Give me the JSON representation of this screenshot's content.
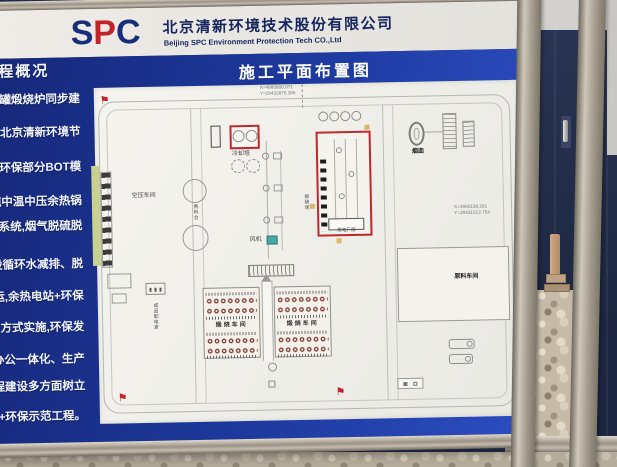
{
  "sign": {
    "header": {
      "logo": {
        "s": "S",
        "p": "P",
        "c": "C"
      },
      "company_cn": "北京清新环境技术股份有限公司",
      "company_en": "Beijing SPC Environment Protection Tech CO.,Ltd"
    },
    "sidebar": {
      "heading": "程概况",
      "lines": [
        "64罐煅烧炉同步建",
        "由北京清新环境节",
        "C+环保部分BOT模",
        "吨中温中压余热锅",
        "保系统,烟气脱硫脱",
        "步建设循环水减排、脱",
        "投运,余热电站+环保",
        "设的方式实施,环保发",
        "生产办公一体化、生产",
        "程、工程建设多方面树立",
        "电+环保示范工程。"
      ]
    },
    "plan": {
      "title": "施工平面布置图",
      "coords_top": {
        "x": "X=4980800.971",
        "y": "Y=29432875.366"
      },
      "coords_right": {
        "x": "X=4980138.291",
        "y": "Y=29431012.754"
      },
      "labels": {
        "cooling_tower": "冷却塔",
        "clinker_silo": "熟料仓",
        "left_workshop": "空压车间",
        "desulfurizer": "脱硫塔",
        "fan": "风机",
        "power_plant": "发电厂房",
        "chimney": "烟囱",
        "raw_material": "原料车间",
        "kiln_left": "煅烧车间",
        "kiln_right": "煅烧车间",
        "distribution_room": "成品配电室"
      }
    }
  },
  "colors": {
    "panel_blue": "#1e3a9f",
    "logo_navy": "#172f7b",
    "logo_red": "#c2232b",
    "highlight_red": "#c0262c",
    "fan_teal": "#4aa8a4",
    "container_navy": "#232e4a",
    "gravel_tan": "#c6bba8"
  }
}
